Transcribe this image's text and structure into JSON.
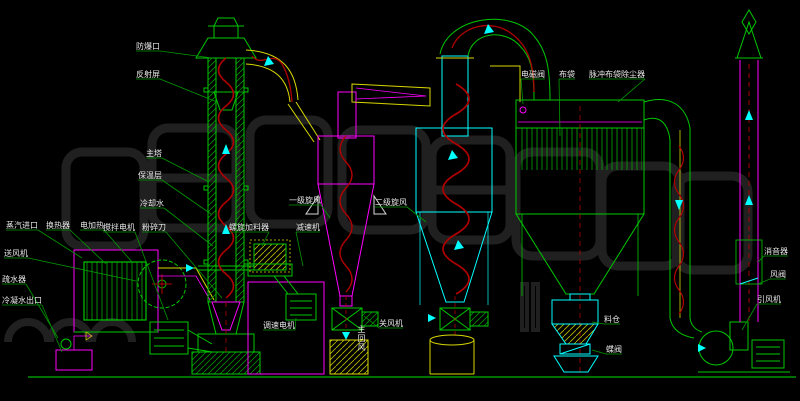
{
  "diagram": {
    "type": "cad-process-flow-drawing",
    "subject": "spin-flash dryer system piping and equipment diagram",
    "background": "#000000"
  },
  "colors": {
    "equipment_green": "#00c800",
    "equipment_magenta": "#ff00ff",
    "equipment_cyan": "#00ffff",
    "air_spiral_red": "#b00000",
    "duct_yellow": "#d8d800",
    "label_text": "#e8e8e8",
    "leader_green": "#009900",
    "watermark_gray": "#242424",
    "support_white": "#d8d8d8"
  },
  "labels": [
    {
      "id": "explosion-vent",
      "text": "防爆口",
      "x": 136,
      "y": 42,
      "leader": {
        "x": 212,
        "y": 58
      }
    },
    {
      "id": "reflection-screen",
      "text": "反射屏",
      "x": 136,
      "y": 70,
      "leader": {
        "x": 217,
        "y": 102
      }
    },
    {
      "id": "main-tower",
      "text": "主塔",
      "x": 146,
      "y": 149,
      "leader": {
        "x": 209,
        "y": 182
      }
    },
    {
      "id": "insulation-layer",
      "text": "保温层",
      "x": 138,
      "y": 171,
      "leader": {
        "x": 211,
        "y": 214
      }
    },
    {
      "id": "cooling-water",
      "text": "冷却水",
      "x": 140,
      "y": 199,
      "leader": {
        "x": 213,
        "y": 246
      }
    },
    {
      "id": "agitator-motor",
      "text": "搅拌电机",
      "x": 103,
      "y": 223,
      "leader": {
        "x": 168,
        "y": 320
      }
    },
    {
      "id": "crusher-blade",
      "text": "粉碎刀",
      "x": 142,
      "y": 223,
      "leader": {
        "x": 222,
        "y": 298
      }
    },
    {
      "id": "steam-inlet",
      "text": "蒸汽进口",
      "x": 6,
      "y": 221,
      "leader": {
        "x": 82,
        "y": 258
      }
    },
    {
      "id": "heat-exchanger",
      "text": "换热器",
      "x": 46,
      "y": 221,
      "leader": {
        "x": 106,
        "y": 264
      }
    },
    {
      "id": "electric-heater",
      "text": "电加热",
      "x": 80,
      "y": 221,
      "leader": {
        "x": 132,
        "y": 262
      }
    },
    {
      "id": "feed-blower",
      "text": "送风机",
      "x": 4,
      "y": 249,
      "leader": {
        "x": 136,
        "y": 281
      }
    },
    {
      "id": "steam-trap",
      "text": "疏水器",
      "x": 2,
      "y": 275,
      "leader": {
        "x": 58,
        "y": 338
      }
    },
    {
      "id": "condensate-outlet",
      "text": "冷凝水出口",
      "x": 2,
      "y": 296,
      "leader": {
        "x": 62,
        "y": 352
      }
    },
    {
      "id": "screw-feeder",
      "text": "螺旋加料器",
      "x": 229,
      "y": 223,
      "leader": {
        "x": 262,
        "y": 246
      }
    },
    {
      "id": "speed-reducer",
      "text": "减速机",
      "x": 296,
      "y": 223,
      "leader": {
        "x": 303,
        "y": 266
      }
    },
    {
      "id": "variable-speed-motor",
      "text": "调速电机",
      "x": 263,
      "y": 321,
      "leader": {
        "x": 296,
        "y": 318
      }
    },
    {
      "id": "primary-cyclone",
      "text": "一级旋风",
      "x": 289,
      "y": 196,
      "leader": {
        "x": 330,
        "y": 218
      }
    },
    {
      "id": "secondary-cyclone",
      "text": "二级旋风",
      "x": 375,
      "y": 198,
      "leader": {
        "x": 426,
        "y": 222
      }
    },
    {
      "id": "main-return-air",
      "text": "主回风",
      "x": 357,
      "y": 325,
      "vertical": true
    },
    {
      "id": "rotary-valve",
      "text": "关风机",
      "x": 379,
      "y": 319,
      "leader": {
        "x": 364,
        "y": 316
      }
    },
    {
      "id": "solenoid-valve",
      "text": "电磁阀",
      "x": 521,
      "y": 70,
      "leader": {
        "x": 523,
        "y": 104
      }
    },
    {
      "id": "filter-bag",
      "text": "布袋",
      "x": 559,
      "y": 70,
      "leader": {
        "x": 560,
        "y": 136
      }
    },
    {
      "id": "pulse-bag-dust-collector",
      "text": "脉冲布袋除尘器",
      "x": 589,
      "y": 70,
      "leader": {
        "x": 618,
        "y": 102
      }
    },
    {
      "id": "material-bin",
      "text": "料仓",
      "x": 604,
      "y": 315,
      "leader": {
        "x": 592,
        "y": 322
      }
    },
    {
      "id": "butterfly-valve",
      "text": "蝶阀",
      "x": 606,
      "y": 345,
      "leader": {
        "x": 592,
        "y": 350
      }
    },
    {
      "id": "silencer",
      "text": "消音器",
      "x": 764,
      "y": 247,
      "leader": {
        "x": 758,
        "y": 262
      }
    },
    {
      "id": "air-damper",
      "text": "风阀",
      "x": 770,
      "y": 270,
      "leader": {
        "x": 758,
        "y": 284
      }
    },
    {
      "id": "induced-draft-fan",
      "text": "引风机",
      "x": 757,
      "y": 295,
      "leader": {
        "x": 742,
        "y": 330
      }
    }
  ]
}
